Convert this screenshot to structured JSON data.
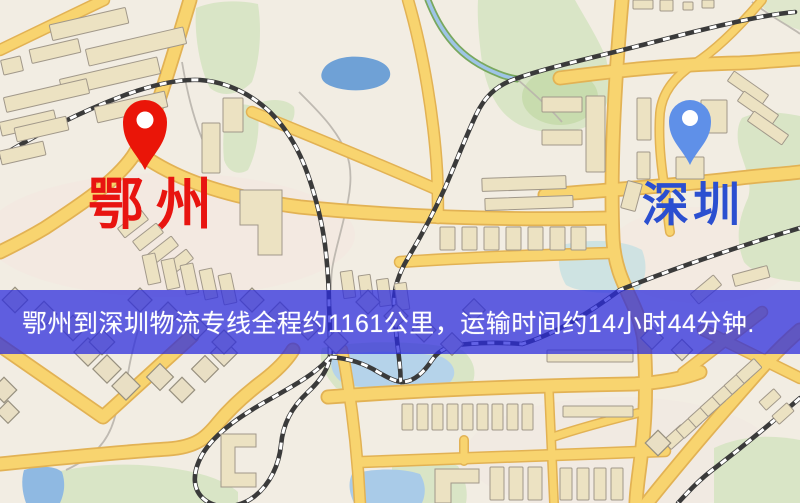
{
  "map": {
    "origin": {
      "label": "鄂州",
      "pin_color": "#ea1508",
      "label_color": "#e81410"
    },
    "destination": {
      "label": "深圳",
      "pin_color": "#5f90e8",
      "label_color": "#2b4fd0"
    }
  },
  "banner": {
    "text": "鄂州到深圳物流专线全程约1161公里，运输时间约14小时44分钟.",
    "background_color": "rgba(43,43,221,0.74)",
    "text_color": "#ffffff",
    "origin": "鄂州",
    "destination": "深圳",
    "distance_km": "1161",
    "duration": "14小时44分钟"
  },
  "palette": {
    "background": "#f2ede3",
    "road_fill": "#f8d46f",
    "road_casing": "#e2b254",
    "building": "#ece2c2",
    "park": "#d9e5c6",
    "water": "#72a3d8",
    "railway": "#3a3a3a"
  }
}
